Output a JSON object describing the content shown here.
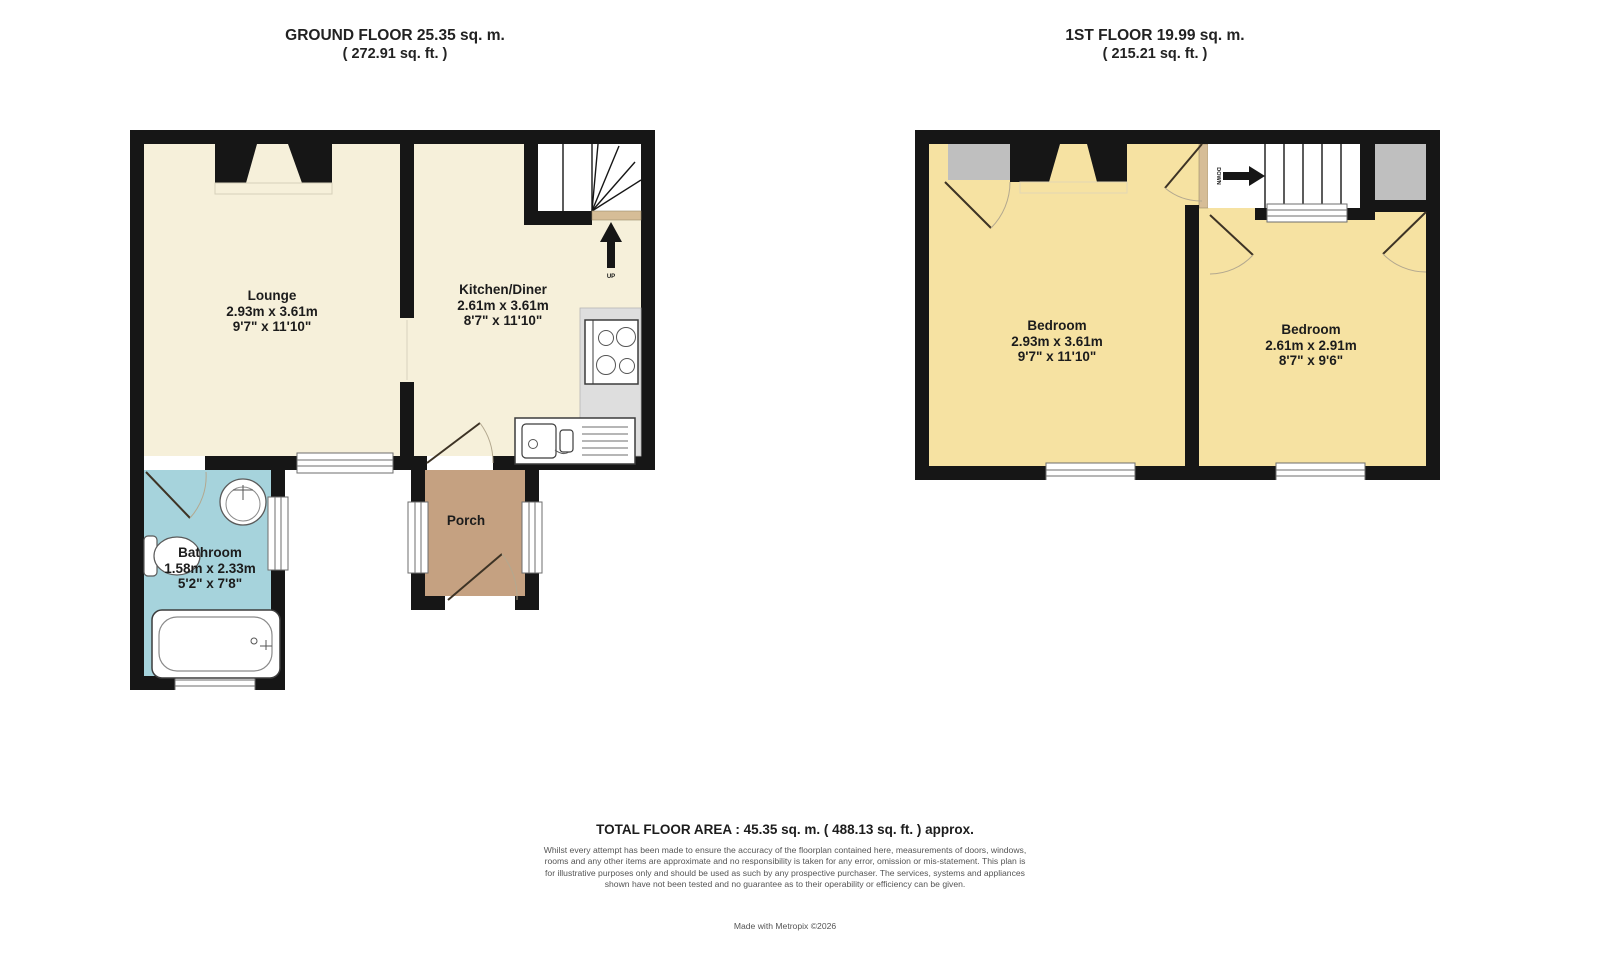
{
  "ground_floor": {
    "title": "GROUND FLOOR 25.35 sq. m.",
    "subtitle": "( 272.91 sq. ft. )",
    "rooms": {
      "lounge": {
        "name": "Lounge",
        "metric": "2.93m x 3.61m",
        "imperial": "9'7\" x 11'10\""
      },
      "kitchen": {
        "name": "Kitchen/Diner",
        "metric": "2.61m x 3.61m",
        "imperial": "8'7\" x 11'10\""
      },
      "bathroom": {
        "name": "Bathroom",
        "metric": "1.58m x 2.33m",
        "imperial": "5'2\" x 7'8\""
      },
      "porch": {
        "name": "Porch"
      }
    },
    "stairs_label": "UP"
  },
  "first_floor": {
    "title": "1ST FLOOR 19.99 sq. m.",
    "subtitle": "( 215.21 sq. ft. )",
    "rooms": {
      "bedroom1": {
        "name": "Bedroom",
        "metric": "2.93m x 3.61m",
        "imperial": "9'7\" x 11'10\""
      },
      "bedroom2": {
        "name": "Bedroom",
        "metric": "2.61m x 2.91m",
        "imperial": "8'7\" x 9'6\""
      }
    },
    "stairs_label": "DOWN"
  },
  "footer": {
    "total": "TOTAL FLOOR AREA : 45.35 sq. m. ( 488.13 sq. ft. ) approx.",
    "disclaimer": "Whilst every attempt has been made to ensure the accuracy of the floorplan contained here, measurements of doors, windows, rooms and any other items are approximate and no responsibility is taken for any error, omission or mis-statement. This plan is for illustrative purposes only and should be used as such by any prospective purchaser. The services, systems and appliances shown have not been tested and no guarantee as to their operability or efficiency can be given.",
    "credit": "Made with Metropix ©2026"
  },
  "colors": {
    "wall": "#161616",
    "ground_floor_room": "#f6f0da",
    "bathroom": "#a6d3dc",
    "porch": "#c5a181",
    "bedroom": "#f6e2a2",
    "cupboard": "#bfbfbf",
    "threshold": "#d6bd97"
  }
}
